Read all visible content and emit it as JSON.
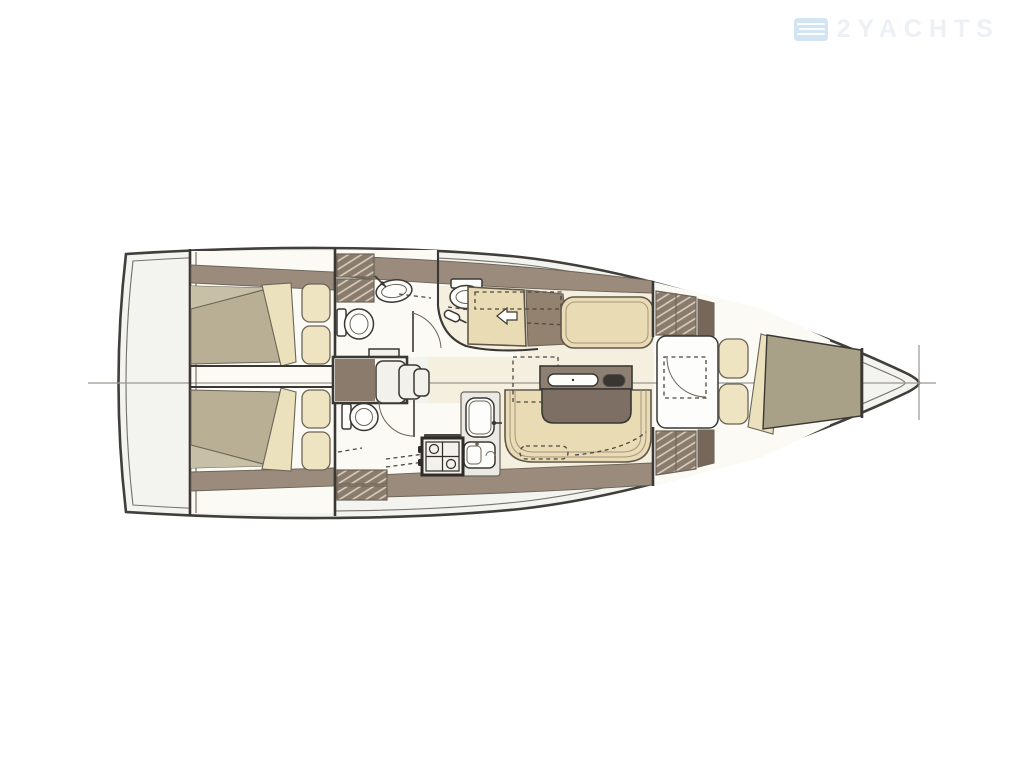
{
  "watermark": {
    "text": "2YACHTS",
    "logo_icon": "waves-logo-icon"
  },
  "palette": {
    "hull_stroke": "#413f3b",
    "hull_inner": "#75726a",
    "hull_fill": "#f3f3ef",
    "floor_white": "#fbfaf5",
    "salon_floor": "#f5efe0",
    "band": "#9a8b7c",
    "wood_mid": "#93826f",
    "locker": "#8b7b6c",
    "locker_dark": "#76675a",
    "hatch_line": "#dbd3c5",
    "line_dark": "#3b3834",
    "line_mid": "#6b6457",
    "bed_olive": "#b8af94",
    "bed_olive_light": "#c7bfa6",
    "bow_olive": "#a8a187",
    "wedge": "#ece1bd",
    "settee": "#e9dcb5",
    "settee_edge": "#60574b",
    "settee_inner": "#a4947c",
    "cushion": "#efe4c1",
    "table_top": "#8d7f72",
    "table_dark": "#7d6f63",
    "table_pill": "#393631",
    "fixture": "#fdfdfb",
    "counter": "#ebe9e3",
    "steel": "#f2f1ec",
    "centerline": "#9a968f",
    "dash": "#4b4742",
    "watermark_text": "#edf0f4",
    "watermark_logo": "#d3e4f2"
  }
}
